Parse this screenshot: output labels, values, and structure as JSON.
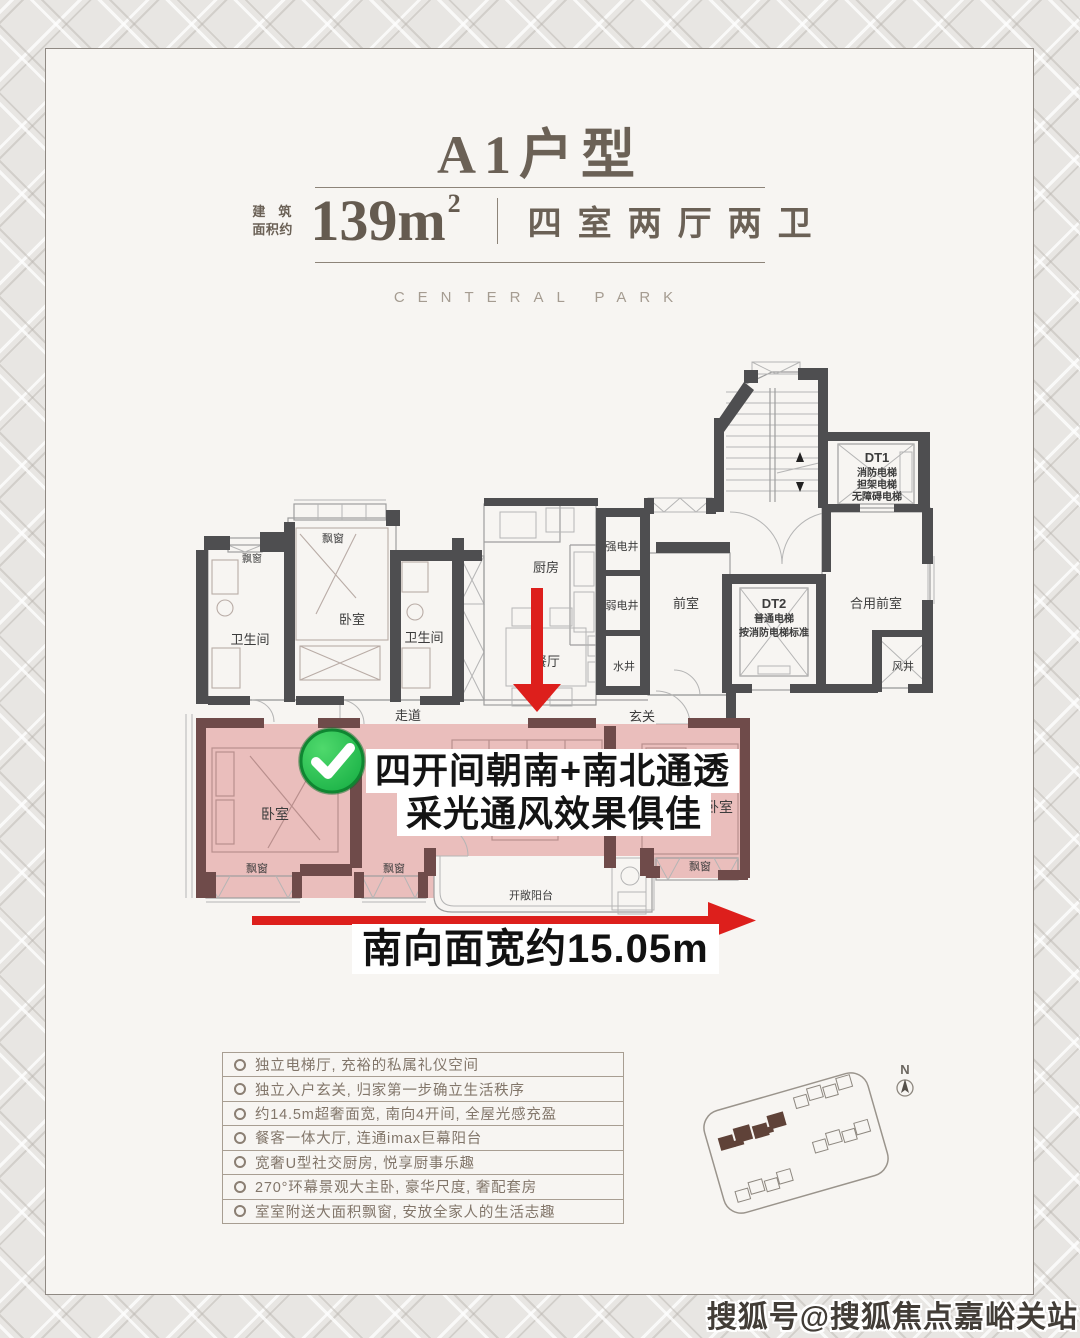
{
  "header": {
    "title": "A1户型",
    "area_label_top": "建筑",
    "area_label_bottom": "面积约",
    "area_value": "139m",
    "area_sup": "2",
    "layout_text": "四室两厅两卫",
    "brand": "CENTERAL PARK"
  },
  "plan": {
    "rooms": {
      "bay_window": "飘窗",
      "bedroom": "卧室",
      "bathroom": "卫生间",
      "kitchen": "厨房",
      "dining": "餐厅",
      "corridor": "走道",
      "entry": "玄关",
      "strong_elec_shaft": "强电井",
      "weak_elec_shaft": "弱电井",
      "water_shaft": "水井",
      "front_room": "前室",
      "shared_front_room": "合用前室",
      "wind_shaft": "风井",
      "balcony": "开敞阳台"
    },
    "elevators": {
      "dt1_name": "DT1",
      "dt1_line1": "消防电梯",
      "dt1_line2": "担架电梯",
      "dt1_line3": "无障碍电梯",
      "dt2_name": "DT2",
      "dt2_line1": "普通电梯",
      "dt2_line2": "按消防电梯标准"
    },
    "callout": {
      "line1": "四开间朝南+南北通透",
      "line2": "采光通风效果俱佳"
    },
    "south_width": "南向面宽约15.05m"
  },
  "features": {
    "items": [
      "独立电梯厅, 充裕的私属礼仪空间",
      "独立入户玄关, 归家第一步确立生活秩序",
      "约14.5m超奢面宽, 南向4开间, 全屋光感充盈",
      "餐客一体大厅, 连通imax巨幕阳台",
      "宽奢U型社交厨房, 悦享厨事乐趣",
      "270°环幕景观大主卧, 豪华尺度, 奢配套房",
      "室室附送大面积飘窗, 安放全家人的生活志趣"
    ]
  },
  "sitemap": {
    "north": "N"
  },
  "watermark": "搜狐号@搜狐焦点嘉峪关站",
  "colors": {
    "accent_red": "#dd1f1c",
    "check_green": "#2fc150",
    "highlight_pink": "#e9b9b6",
    "wall_dark": "#4e4e50",
    "wall_red": "#6f4b4a",
    "title_brown": "#6b6156"
  }
}
